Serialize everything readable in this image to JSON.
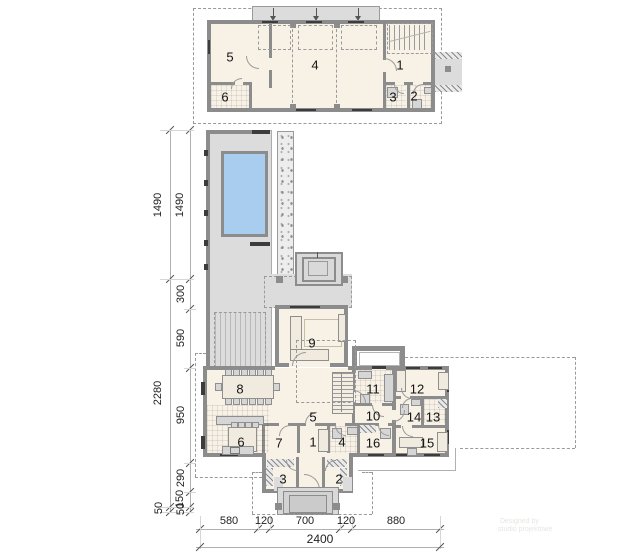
{
  "upper_plan": {
    "rooms": {
      "r1": "1",
      "r2": "2",
      "r3": "3",
      "r4": "4",
      "r5": "5",
      "r6": "6"
    }
  },
  "main_plan": {
    "rooms": {
      "r1": "1",
      "r2": "2",
      "r3": "3",
      "r4": "4",
      "r5": "5",
      "r6": "6",
      "r7": "7",
      "r8": "8",
      "r9": "9",
      "r10": "10",
      "r11": "11",
      "r12": "12",
      "r13": "13",
      "r14": "14",
      "r15": "15",
      "r16": "16"
    }
  },
  "dimensions": {
    "left_outer": [
      "1490",
      "2280",
      "50"
    ],
    "left_inner": [
      "1490",
      "300",
      "590",
      "950",
      "290",
      "150",
      "50"
    ],
    "bottom": [
      "580",
      "120",
      "700",
      "120",
      "880"
    ],
    "bottom_total": "2400"
  },
  "watermark": {
    "line1": "Designed by",
    "line2": "studio projektowe"
  },
  "colors": {
    "wall": "#8c8c8c",
    "room_fill": "#f7f1e6",
    "terrace": "#dcdcdc",
    "pool": "#a9cdee",
    "dash": "#9a9a9a"
  }
}
